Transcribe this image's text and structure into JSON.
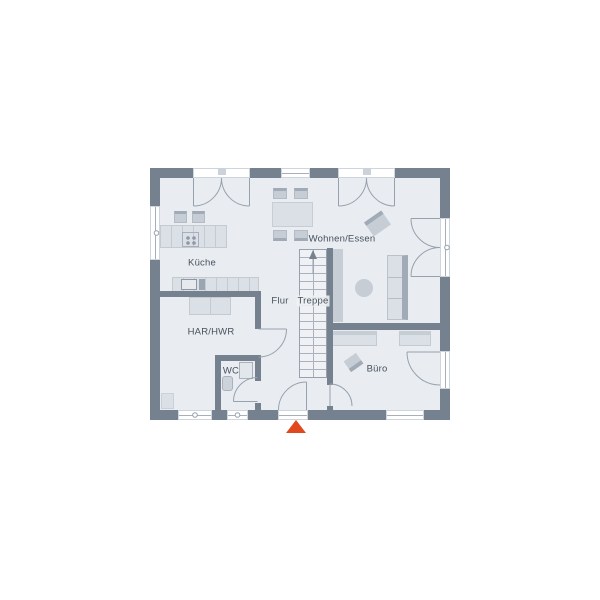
{
  "plan": {
    "rooms": [
      {
        "id": "kueche",
        "label": "Küche"
      },
      {
        "id": "wohnen-essen",
        "label": "Wohnen/Essen"
      },
      {
        "id": "flur",
        "label": "Flur"
      },
      {
        "id": "treppe",
        "label": "Treppe"
      },
      {
        "id": "har-hwr",
        "label": "HAR/HWR"
      },
      {
        "id": "wc",
        "label": "WC"
      },
      {
        "id": "buero",
        "label": "Büro"
      }
    ],
    "icons": {
      "entrance_marker": "triangle-up",
      "stairs_direction": "arrow-up"
    },
    "colors": {
      "wall": "#76818f",
      "floor": "#e9edf2",
      "furn-light": "#dbe0e6",
      "furn-mid": "#c6cdd5",
      "furn-dark": "#a0abb7",
      "line": "#97a1ad",
      "label": "#47505c",
      "stairs-bg": "#eff1f4",
      "accent": "#e0481d"
    }
  }
}
